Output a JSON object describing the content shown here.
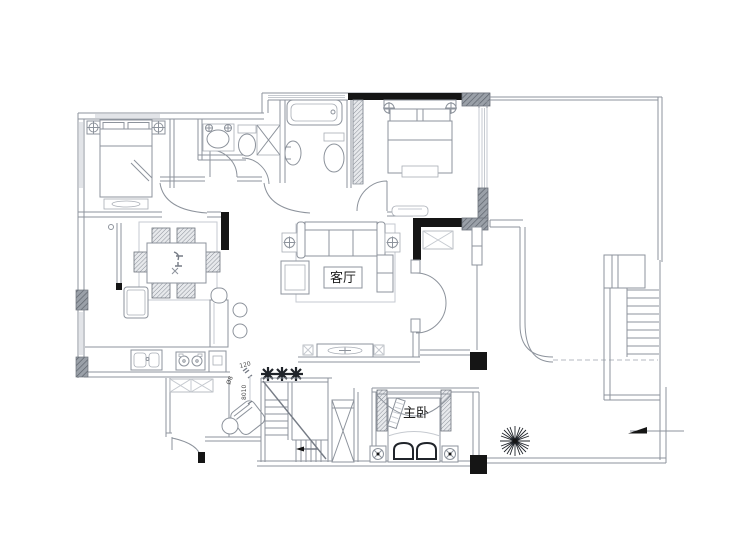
{
  "plan": {
    "rooms": {
      "living_room_label": "客厅",
      "master_bedroom_label": "主卧"
    },
    "annotations": {
      "dim_width": "120",
      "dim_rail": "Ø8",
      "dim_run": "8010"
    },
    "icons": {
      "entry_arrow": "direction-arrow-left",
      "plants": "plant-starburst",
      "lamps": "crosshair-lamp"
    },
    "colors": {
      "wall_line": "#8d939c",
      "black_wall": "#151515",
      "hatch_block": "#868c96",
      "background": "#ffffff"
    }
  }
}
